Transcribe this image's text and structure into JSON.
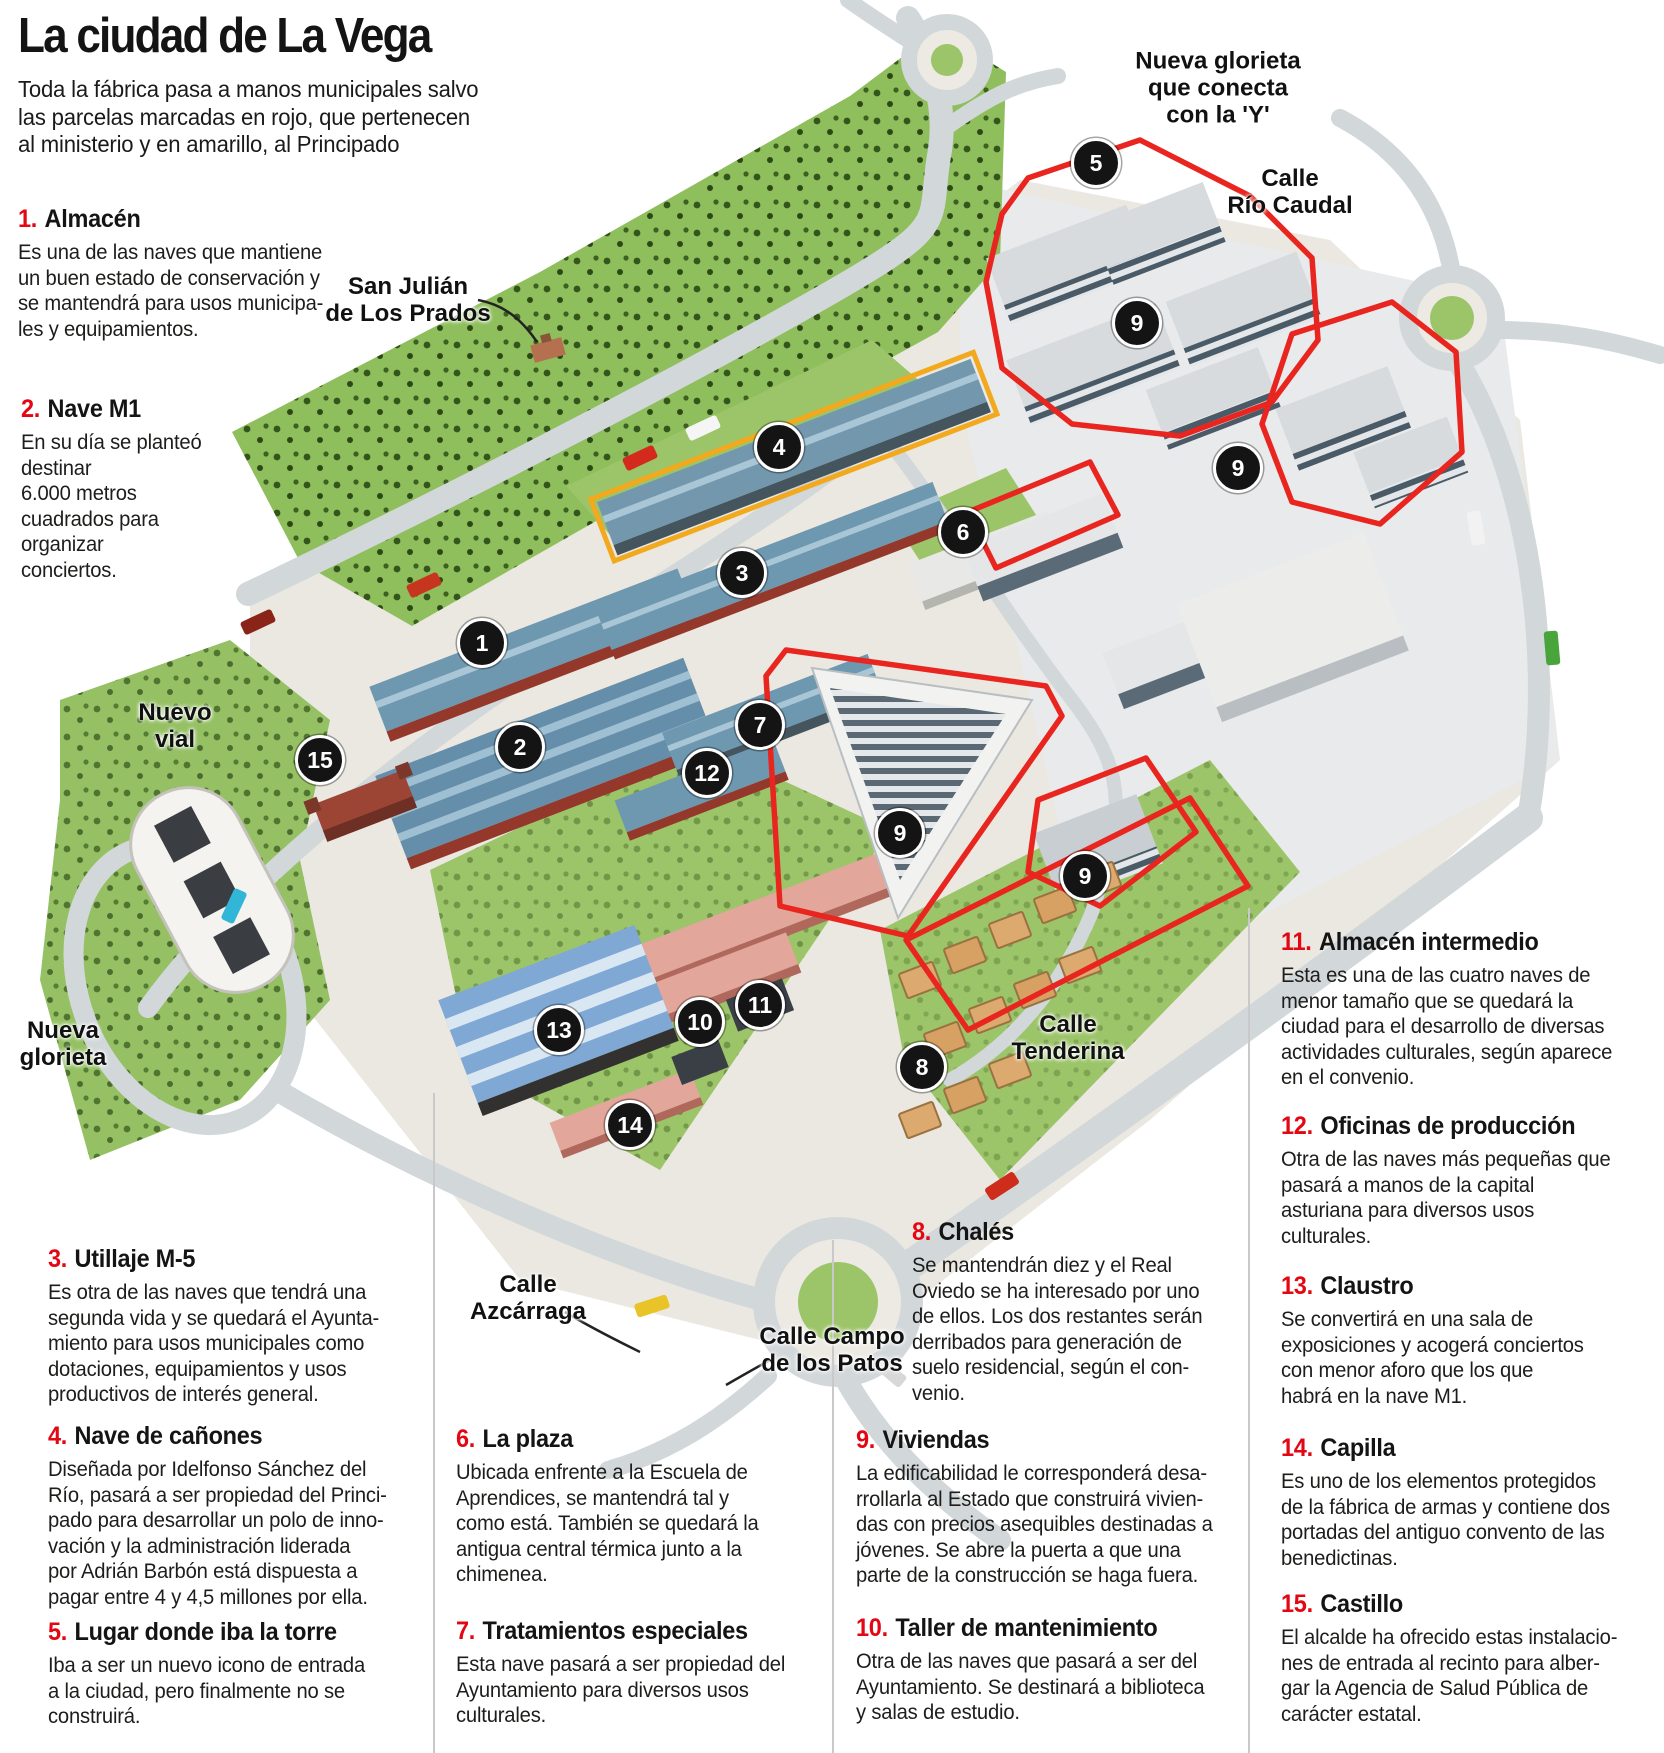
{
  "header": {
    "title": "La ciudad de La Vega",
    "subtitle": "Toda la fábrica pasa a manos municipales salvo\nlas parcelas marcadas en rojo, que pertenecen\nal ministerio y en amarillo, al Principado"
  },
  "colors": {
    "accent_red": "#e30613",
    "parcel_red": "#e8251f",
    "parcel_yellow": "#f2a91d",
    "marker_bg": "#141414",
    "roof_blue": "#6e97b0",
    "grass_green": "#8fbe5c"
  },
  "legend": [
    {
      "num": "1.",
      "title": "Almacén",
      "body": "Es una de las naves que mantiene\nun buen estado de conservación y\nse mantendrá para usos municipa-\nles y equipamientos."
    },
    {
      "num": "2.",
      "title": "Nave M1",
      "body": "En su día se planteó\ndestinar\n6.000 metros\ncuadrados para\norganizar\nconciertos."
    },
    {
      "num": "3.",
      "title": "Utillaje M-5",
      "body": "Es otra de las naves que tendrá una\nsegunda vida y se quedará el Ayunta-\nmiento para usos municipales como\ndotaciones, equipamientos y usos\nproductivos de interés general."
    },
    {
      "num": "4.",
      "title": "Nave de cañones",
      "body": "Diseñada por Idelfonso Sánchez del\nRío, pasará a ser propiedad del Princi-\npado para desarrollar un polo de inno-\nvación y la administración liderada\npor Adrián Barbón está dispuesta a\npagar entre 4 y 4,5 millones por ella."
    },
    {
      "num": "5.",
      "title": "Lugar donde iba la torre",
      "body": "Iba a ser un nuevo icono de entrada\na la ciudad, pero finalmente no se\nconstruirá."
    },
    {
      "num": "6.",
      "title": "La plaza",
      "body": "Ubicada enfrente a la Escuela de\nAprendices, se mantendrá tal y\ncomo está. También se quedará la\nantigua central térmica junto a la\nchimenea."
    },
    {
      "num": "7.",
      "title": "Tratamientos especiales",
      "body": "Esta nave pasará a ser propiedad del\nAyuntamiento para diversos usos\nculturales."
    },
    {
      "num": "8.",
      "title": "Chalés",
      "body": "Se mantendrán diez y el Real\nOviedo se ha interesado por uno\nde ellos. Los dos restantes serán\nderribados para generación de\nsuelo residencial, según el con-\nvenio."
    },
    {
      "num": "9.",
      "title": "Viviendas",
      "body": "La edificabilidad le corresponderá desa-\nrrollarla al Estado que construirá vivien-\ndas con precios asequibles destinadas a\njóvenes. Se abre la puerta a que una\nparte de la construcción se haga fuera."
    },
    {
      "num": "10.",
      "title": "Taller de mantenimiento",
      "body": "Otra de las naves que pasará a ser del\nAyuntamiento. Se destinará a biblioteca\ny salas de estudio."
    },
    {
      "num": "11.",
      "title": "Almacén intermedio",
      "body": "Esta es una de las cuatro naves de\nmenor tamaño que se quedará la\nciudad para el desarrollo de diversas\nactividades culturales, según aparece\nen el convenio."
    },
    {
      "num": "12.",
      "title": "Oficinas de producción",
      "body": "Otra de las naves más pequeñas que\npasará a manos de la capital\nasturiana para diversos usos\nculturales."
    },
    {
      "num": "13.",
      "title": "Claustro",
      "body": "Se convertirá en una sala de\nexposiciones y acogerá conciertos\ncon menor aforo que los que\nhabrá en la nave M1."
    },
    {
      "num": "14.",
      "title": "Capilla",
      "body": "Es uno de los elementos protegidos\nde la fábrica de armas y contiene dos\nportadas del antiguo convento de las\nbenedictinas."
    },
    {
      "num": "15.",
      "title": "Castillo",
      "body": "El alcalde ha ofrecido estas instalacio-\nnes de entrada al recinto para alber-\ngar la Agencia de Salud Pública de\ncarácter estatal."
    }
  ],
  "map_labels": [
    {
      "id": "san-julian",
      "text": "San Julián\nde Los Prados",
      "x": 408,
      "y": 300
    },
    {
      "id": "nueva-glorieta-y",
      "text": "Nueva glorieta\nque conecta\ncon la 'Y'",
      "x": 1218,
      "y": 88
    },
    {
      "id": "calle-rio-caudal",
      "text": "Calle\nRío Caudal",
      "x": 1290,
      "y": 192
    },
    {
      "id": "nuevo-vial",
      "text": "Nuevo\nvial",
      "x": 175,
      "y": 726
    },
    {
      "id": "nueva-glorieta",
      "text": "Nueva\nglorieta",
      "x": 63,
      "y": 1044
    },
    {
      "id": "calle-tenderina",
      "text": "Calle\nTenderina",
      "x": 1068,
      "y": 1038
    },
    {
      "id": "calle-azcarraga",
      "text": "Calle\nAzcárraga",
      "x": 528,
      "y": 1298
    },
    {
      "id": "calle-campo-de-los-patos",
      "text": "Calle Campo\nde los Patos",
      "x": 832,
      "y": 1350
    }
  ],
  "markers": [
    {
      "n": "1",
      "x": 482,
      "y": 643
    },
    {
      "n": "2",
      "x": 520,
      "y": 747
    },
    {
      "n": "3",
      "x": 742,
      "y": 573
    },
    {
      "n": "4",
      "x": 779,
      "y": 447
    },
    {
      "n": "5",
      "x": 1096,
      "y": 163
    },
    {
      "n": "6",
      "x": 963,
      "y": 532
    },
    {
      "n": "7",
      "x": 760,
      "y": 725
    },
    {
      "n": "8",
      "x": 922,
      "y": 1067
    },
    {
      "n": "9",
      "x": 1137,
      "y": 323
    },
    {
      "n": "9",
      "x": 1238,
      "y": 468
    },
    {
      "n": "9",
      "x": 900,
      "y": 833
    },
    {
      "n": "9",
      "x": 1085,
      "y": 876
    },
    {
      "n": "10",
      "x": 700,
      "y": 1022
    },
    {
      "n": "11",
      "x": 760,
      "y": 1005
    },
    {
      "n": "12",
      "x": 707,
      "y": 773
    },
    {
      "n": "13",
      "x": 559,
      "y": 1030
    },
    {
      "n": "14",
      "x": 630,
      "y": 1125
    },
    {
      "n": "15",
      "x": 320,
      "y": 760
    }
  ]
}
